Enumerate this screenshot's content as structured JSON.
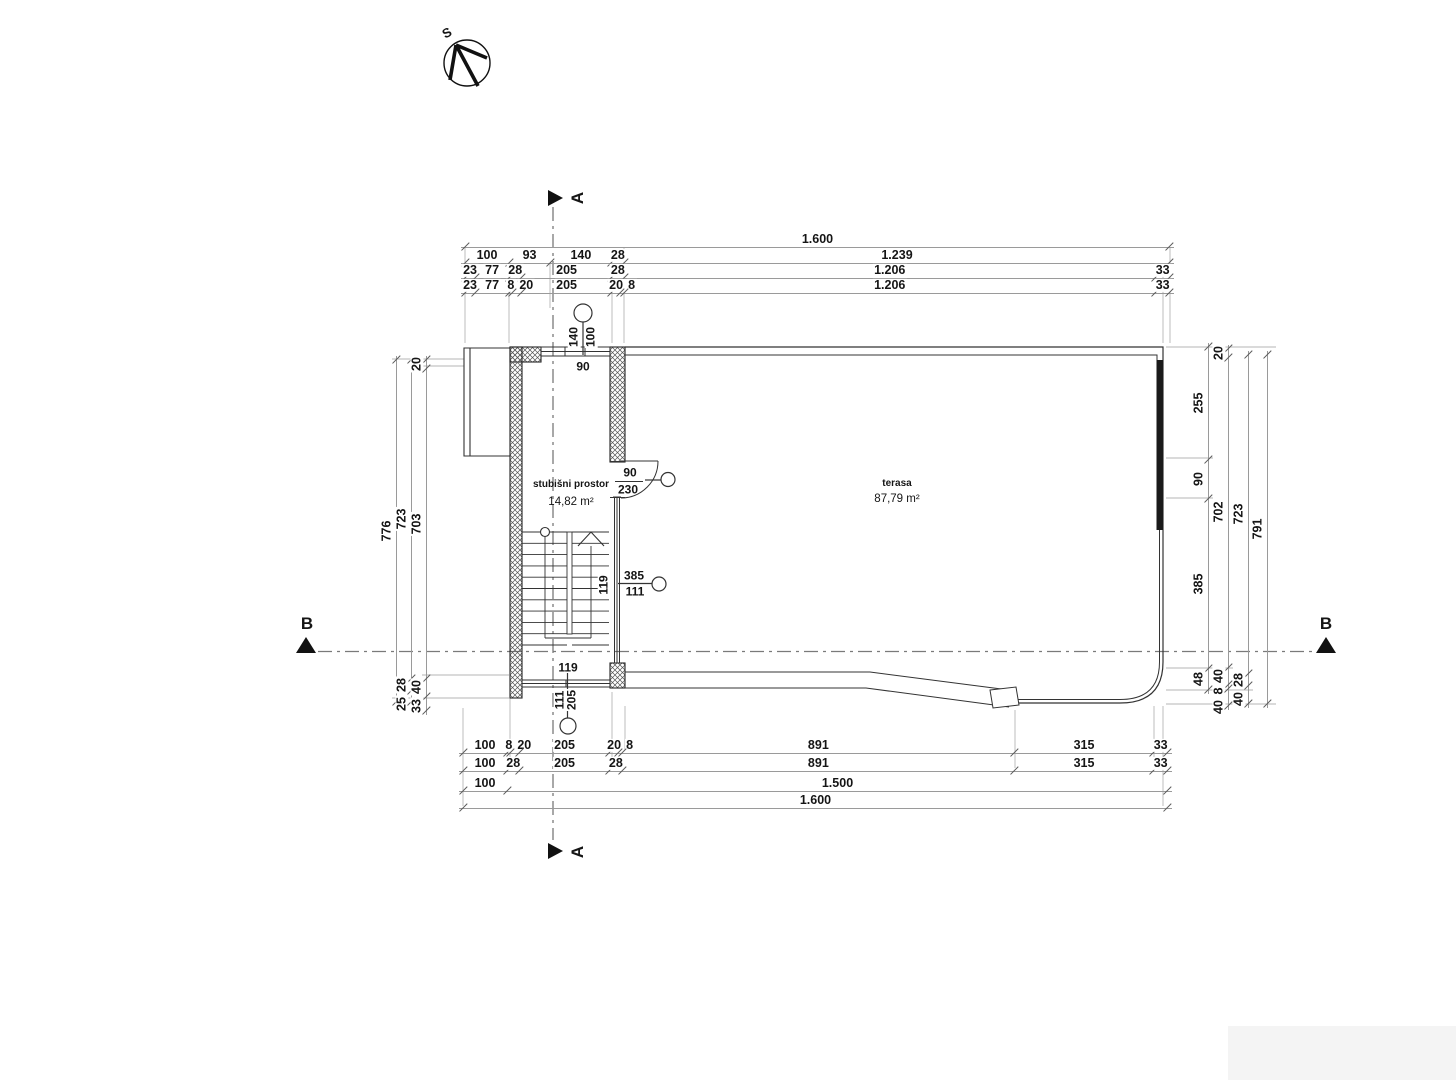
{
  "compass": {
    "label": "S"
  },
  "section_markers": {
    "a": "A",
    "b": "B"
  },
  "rooms": {
    "stairwell": {
      "name": "stubišni prostor",
      "area": "14,82 m²"
    },
    "terrace": {
      "name": "terasa",
      "area": "87,79 m²"
    }
  },
  "annotations": {
    "window_top": {
      "width": "140",
      "sill": "100",
      "clear": "90"
    },
    "door": {
      "width": "90",
      "height": "230"
    },
    "mid": {
      "num": "385",
      "den": "111",
      "side": "119"
    },
    "bottom": {
      "side": "119",
      "den": "111",
      "num": "205"
    }
  },
  "dim_chains": {
    "top1": {
      "labels": [
        "1.600"
      ]
    },
    "top2": {
      "labels": [
        "100",
        "93",
        "140",
        "28",
        "1.239"
      ]
    },
    "top3": {
      "labels": [
        "23",
        "77",
        "28",
        "205",
        "28",
        "1.206",
        "33"
      ]
    },
    "top4": {
      "labels": [
        "23",
        "77",
        "8",
        "20",
        "205",
        "20",
        "8",
        "1.206",
        "33"
      ]
    },
    "bottom1": {
      "labels": [
        "100",
        "8",
        "20",
        "205",
        "20",
        "8",
        "891",
        "315",
        "33"
      ]
    },
    "bottom2": {
      "labels": [
        "100",
        "28",
        "205",
        "28",
        "891",
        "315",
        "33"
      ]
    },
    "bottom3": {
      "labels": [
        "100",
        "1.500"
      ]
    },
    "bottom4": {
      "labels": [
        "1.600"
      ]
    },
    "left1": {
      "labels": [
        "776"
      ]
    },
    "left2": {
      "labels": [
        "723",
        "28",
        "25"
      ]
    },
    "left3": {
      "labels": [
        "20",
        "703",
        "40",
        "33"
      ]
    },
    "right1": {
      "labels": [
        "255",
        "90",
        "385",
        "48"
      ]
    },
    "right2": {
      "labels": [
        "20",
        "702",
        "40",
        "8",
        "40"
      ]
    },
    "right3": {
      "labels": [
        "723",
        "28",
        "40"
      ]
    },
    "right4": {
      "labels": [
        "791"
      ]
    }
  },
  "colors": {
    "wall": "#222222",
    "line": "#333333",
    "dim": "#9a9a9a",
    "section": "#7a7a7a"
  }
}
